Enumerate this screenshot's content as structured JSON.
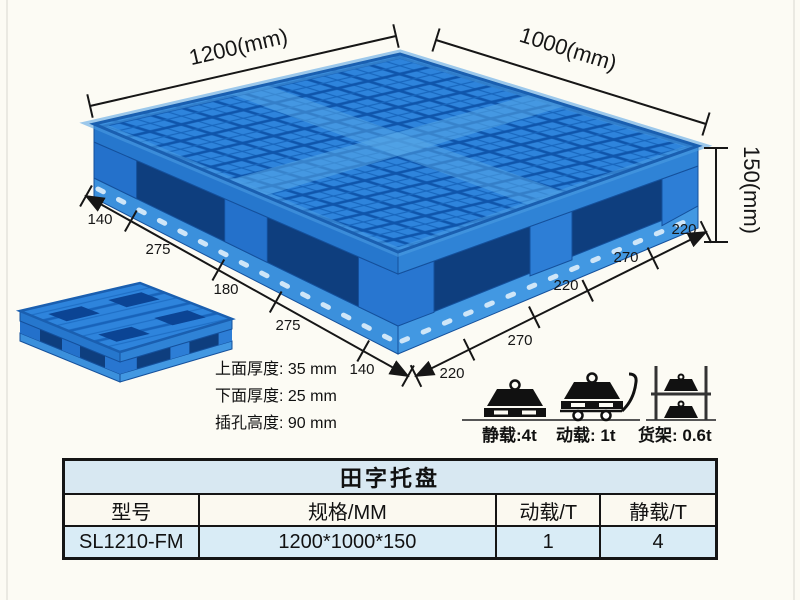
{
  "dimensions": {
    "top_left": "1200(mm)",
    "top_right": "1000(mm)",
    "height": "150(mm)",
    "left_segments": [
      "140",
      "275",
      "180",
      "275",
      "140"
    ],
    "right_segments": [
      "220",
      "270",
      "220",
      "270",
      "220"
    ]
  },
  "specs": {
    "top_thickness": "上面厚度: 35 mm",
    "bottom_thickness": "下面厚度: 25 mm",
    "fork_height": "插孔高度: 90 mm"
  },
  "load_icons": {
    "static_label": "静载:4t",
    "dynamic_label": "动载: 1t",
    "rack_label": "货架: 0.6t"
  },
  "table": {
    "title": "田字托盘",
    "headers": [
      "型号",
      "规格/MM",
      "动载/T",
      "静载/T"
    ],
    "row": [
      "SL1210-FM",
      "1200*1000*150",
      "1",
      "4"
    ]
  },
  "colors": {
    "pallet_blue": "#2e84dc",
    "pallet_dark_blue": "#0e3e7e",
    "grid_line_blue": "#0f55ab",
    "table_light_blue": "#d8e8f2",
    "background": "#fcfbf4"
  }
}
